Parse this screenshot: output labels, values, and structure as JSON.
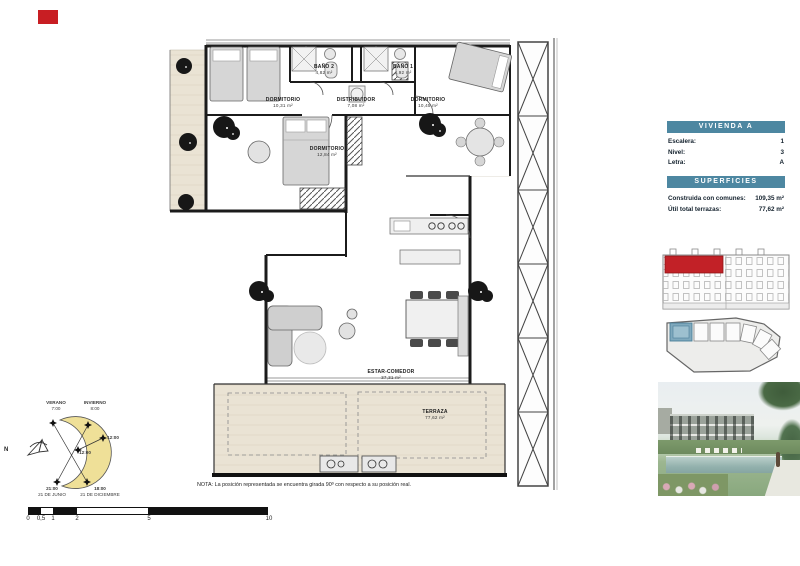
{
  "plan": {
    "note": "NOTA: La posición representada se encuentra girada 90º con respecto a su posición real.",
    "rooms": [
      {
        "name": "DORMITORIO",
        "area": "10,31 m²"
      },
      {
        "name": "BAÑO 2",
        "area": "4,82 m²"
      },
      {
        "name": "DISTRIBUIDOR",
        "area": "7,08 m²"
      },
      {
        "name": "BAÑO 1",
        "area": "4,92 m²"
      },
      {
        "name": "DORMITORIO",
        "area": "10,45 m²"
      },
      {
        "name": "DORMITORIO",
        "area": "12,84 m²"
      },
      {
        "name": "ESTAR-COMEDOR",
        "area": "37,31 m²"
      },
      {
        "name": "TERRAZA",
        "area": "77,62 m²"
      }
    ]
  },
  "sun_diagram": {
    "north": "N",
    "summer_label": "VERANO",
    "summer_time": "7:00",
    "winter_label": "INVIERNO",
    "winter_time": "8:00",
    "noon_outer": "12:00",
    "noon_inner": "12:00",
    "summer_sunset": "21:00",
    "summer_date": "21 DE JUNIO",
    "winter_sunset": "18:00",
    "winter_date": "21 DE DICIEMBRE"
  },
  "scale_bar": {
    "ticks": [
      "0",
      "0,5",
      "1",
      "2",
      "5",
      "10"
    ]
  },
  "sidebar": {
    "vivienda_header": "VIVIENDA A",
    "info_rows": [
      {
        "label": "Escalera:",
        "value": "1"
      },
      {
        "label": "Nivel:",
        "value": "3"
      },
      {
        "label": "Letra:",
        "value": "A"
      }
    ],
    "superficies_header": "SUPERFICIES",
    "superficies_rows": [
      {
        "label": "Construida con comunes:",
        "value": "109,35 m²"
      },
      {
        "label": "Útil total terrazas:",
        "value": "77,62 m²"
      }
    ]
  },
  "colors": {
    "accent": "#4d87a1",
    "unit_highlight_red": "#c22127",
    "unit_highlight_blue": "#7fa9bd"
  }
}
